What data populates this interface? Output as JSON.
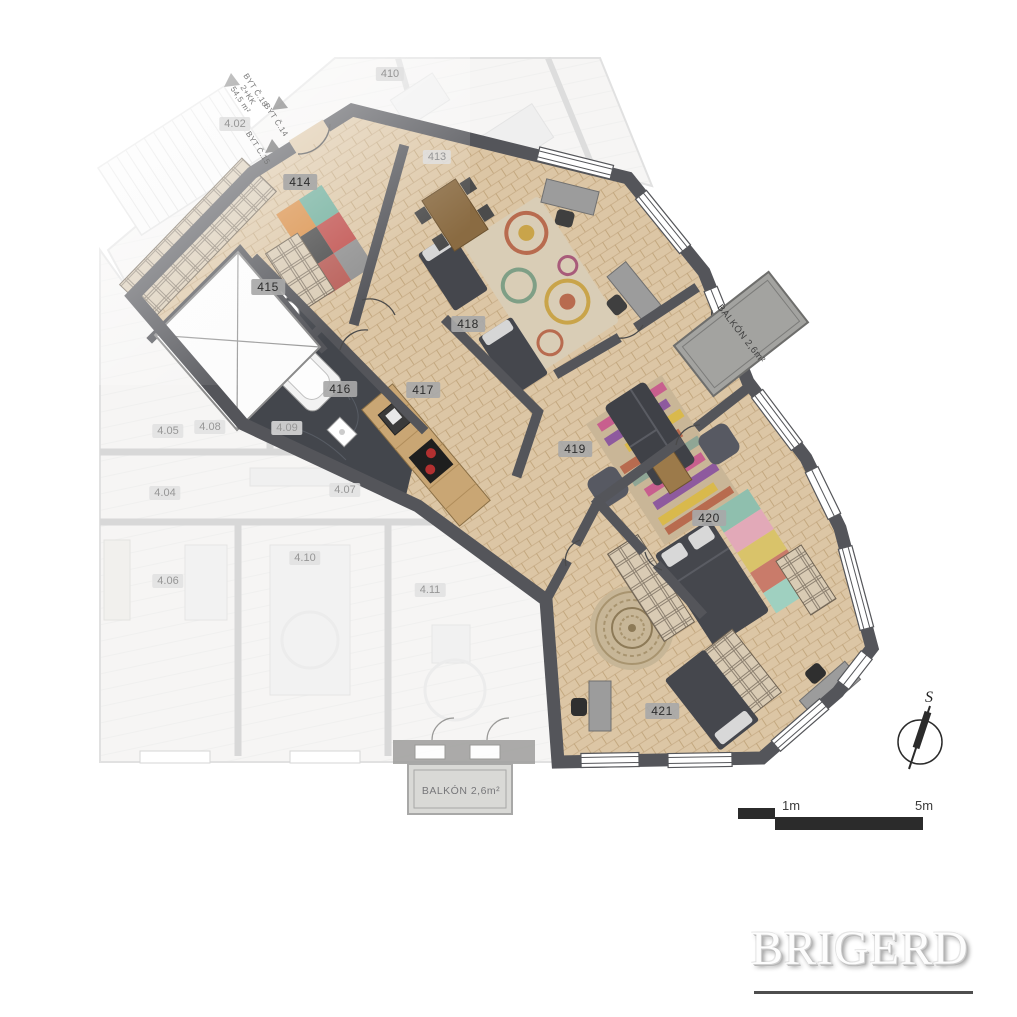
{
  "rooms": {
    "hall": "414",
    "wc": "415",
    "bath": "416",
    "kitchen": "417",
    "kids": "418",
    "living": "419",
    "bedroom": "420",
    "room2": "421"
  },
  "neighbor_rooms": {
    "corridor": "4.02",
    "apt_top_a": "410",
    "apt_top_b": "413",
    "n404": "4.04",
    "n405": "4.05",
    "n406": "4.06",
    "n407": "4.07",
    "n408": "4.08",
    "n409": "4.09",
    "n410": "4.10",
    "n411": "4.11"
  },
  "corridor_signs": {
    "apt18_name": "BYT Č.18",
    "apt18_type": "2+KK",
    "apt18_area": "54,5 m²",
    "apt14": "BYT Č.14",
    "apt15": "BYT Č.15"
  },
  "balconies": {
    "top": "BALKÓN 2,6m²",
    "bottom": "BALKÓN 2,6m²"
  },
  "compass": {
    "north": "S"
  },
  "scale_bar": {
    "near": "1m",
    "far": "5m"
  },
  "brand": {
    "logo": "BRIGERD"
  },
  "colors": {
    "wall": "#54555a",
    "parquet": "#dcc6a5",
    "marble": "#43464c",
    "faded_wall": "#bcbcbc",
    "balcony": "#a3a3a0",
    "accent_red": "#c0504d",
    "accent_teal": "#6fae9b",
    "accent_purple": "#8e5a9e",
    "accent_yellow": "#d9b94c",
    "ink": "#2b2b2b"
  }
}
